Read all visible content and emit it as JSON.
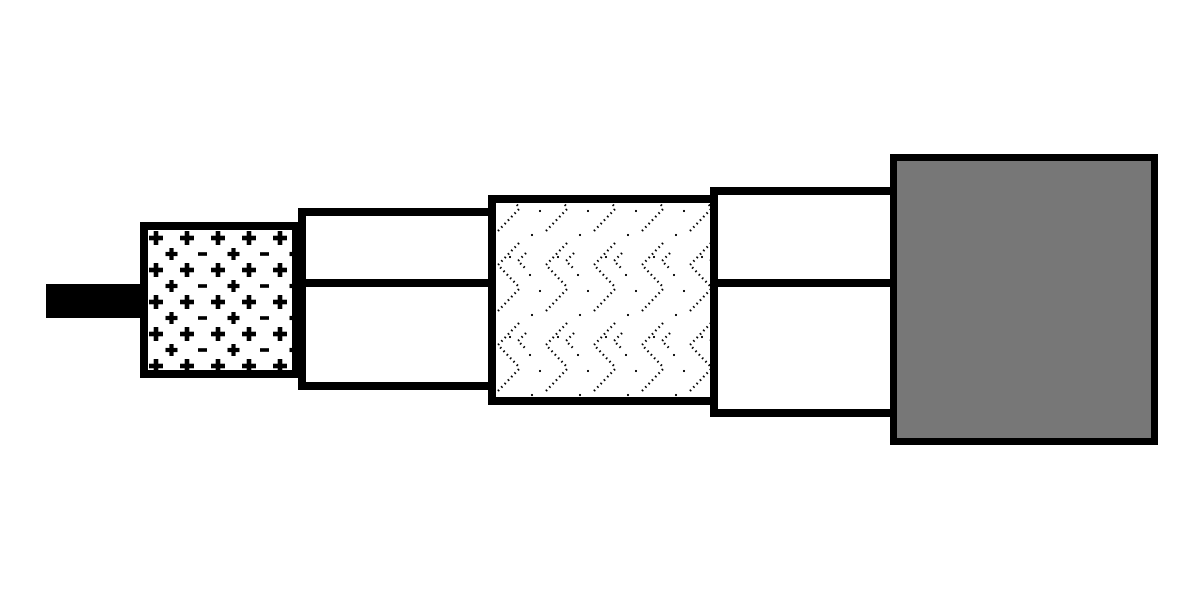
{
  "diagram": {
    "name": "Coaxial cable cutaway construction diagram",
    "type": "cutaway-diagram",
    "visible_text": "",
    "symbols_shown": [
      "+",
      "-"
    ],
    "layers": [
      {
        "id": "center-conductor",
        "label": "Center conductor wire",
        "fill": "#000000",
        "pattern": "solid-black"
      },
      {
        "id": "dielectric",
        "label": "Dielectric insulator with plus and minus marks",
        "fill": "#ffffff",
        "pattern": "plus-minus-grid"
      },
      {
        "id": "inner-shield-layer",
        "label": "Inner layer band split by a horizontal line",
        "fill": "#ffffff",
        "pattern": "horizontal-midline"
      },
      {
        "id": "braided-shield",
        "label": "Braided shield with dotted herringbone weave",
        "fill": "#ffffff",
        "pattern": "dotted-herringbone"
      },
      {
        "id": "outer-shield-layer",
        "label": "Outer layer band split by a horizontal line",
        "fill": "#ffffff",
        "pattern": "horizontal-midline"
      },
      {
        "id": "outer-jacket",
        "label": "Solid gray outer jacket",
        "fill": "#777777",
        "pattern": "solid-gray"
      }
    ]
  },
  "colors": {
    "line-black": "#000000",
    "layer-white": "#ffffff",
    "jacket-gray": "#777777",
    "background": "#ffffff"
  }
}
